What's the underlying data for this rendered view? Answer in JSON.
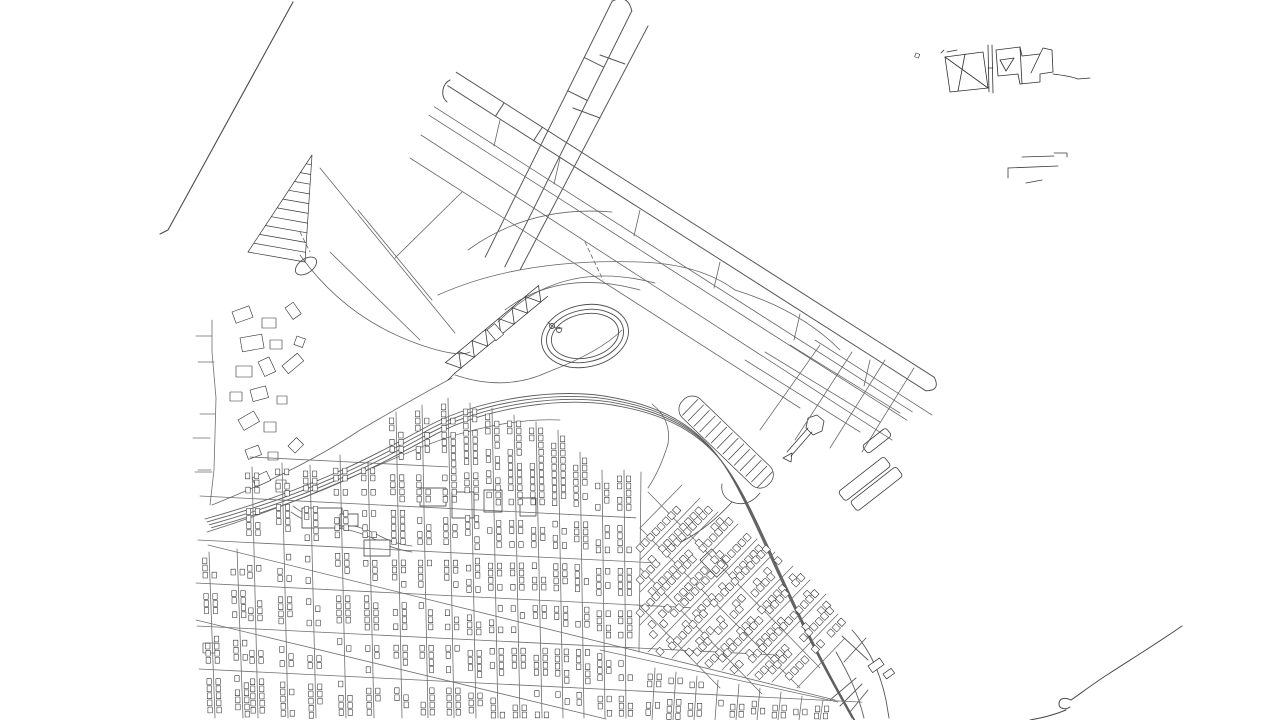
{
  "meta": {
    "kind": "vector-line-map",
    "subject": "airport-and-street-grid-line-drawing",
    "background": "#ffffff",
    "ink_dark": "#2e2e2e",
    "ink_mid": "#555555",
    "ink_street": "#6e6e6e"
  },
  "map": {
    "viewbox": "0 0 1280 720",
    "layers": [
      {
        "name": "nw-boundary-line",
        "stroke": "#4a4a4a",
        "width": 1.1,
        "paths": [
          "M293,2 L168,230 L160,234"
        ]
      },
      {
        "name": "runway-ne-sw",
        "stroke": "#585858",
        "width": 1.0,
        "paths": [
          "M631.8,10.9 L504.8,266.9",
          "M612.2,1.1 L485.2,257.1",
          "M612.2,1.1 Q628,-6.5 631.8,10.9",
          "M603.8,67.2 L584.2,57.4",
          "M587.4,100.5 L567.7,90.7",
          "M648,26 L520,270",
          "M600,55 L625,64",
          "M573,108 L600,118"
        ]
      },
      {
        "name": "runway-nw-se",
        "stroke": "#585858",
        "width": 1.0,
        "paths": [
          "M456.3,72.3 L934.3,377.3",
          "M447.7,85.7 L925.7,390.7",
          "M934.3,377.3 Q941,391 925.7,390.7",
          "M450,80 C442,84 440,96 447,102",
          "M504.1,102.8 L495.5,116.2",
          "M542.3,127.2 L533.7,140.6"
        ]
      },
      {
        "name": "taxiways",
        "stroke": "#666666",
        "width": 0.8,
        "paths": [
          "M434.3,106.8 L912.3,411.8",
          "M428.9,115.2 L906.9,420.2",
          "M421,135 L892,440",
          "M410,158 L800,408",
          "M500,120 L494,146",
          "M560,158 L554,184",
          "M640,210 L634,236",
          "M720,262 L714,288",
          "M800,314 L794,340",
          "M870,360 L864,386",
          "M320,168 L455,333",
          "M395,258 L462,192",
          "M358,210 L432,300",
          "M330,252 L420,340"
        ]
      },
      {
        "name": "infield-curves",
        "stroke": "#666666",
        "width": 0.8,
        "paths": [
          "M468,250 Q530,205 612,212",
          "M438,295 Q520,258 640,262",
          "M640,262 Q700,264 735,290",
          "M735,290 Q800,310 840,350",
          "M505,310 Q560,268 640,290",
          "M498,322 Q560,258 655,283",
          "M300,255 Q345,318 418,344 Q458,358 470,352",
          "M652,404 Q672,420 668,444",
          "M668,444 Q660,470 648,488",
          "M212,505 Q300,470 360,430 Q420,395 452,378",
          "M455,375 Q505,392 548,372 Q600,352 622,330"
        ]
      },
      {
        "name": "infield-dashes",
        "stroke": "#666666",
        "width": 0.8,
        "dash": "4 3",
        "paths": [
          "M585,242 L603,280",
          "M300,232 L310,252"
        ]
      },
      {
        "name": "pier-hatch-structure",
        "stroke": "#3a3a3a",
        "width": 0.7,
        "paths": [
          "M312,155 L248,252 L305,262 Z",
          "M306.2,163.8 L311.4,164.7",
          "M300.4,172.6 L310.7,174.5",
          "M294.5,181.5 L310.1,184.2",
          "M288.7,190.3 L309.5,193.9",
          "M282.9,199.1 L308.8,203.6",
          "M277.1,207.9 L308.2,213.4",
          "M271.3,216.7 L307.5,223.1",
          "M265.5,225.5 L306.9,232.8",
          "M259.6,234.4 L306.3,242.5",
          "M253.8,243.2 L305.6,252.3"
        ]
      },
      {
        "name": "terminal-zigzag",
        "stroke": "#3a3a3a",
        "width": 0.8,
        "paths": [
          "M454.5,373.4 L547.5,296.4",
          "M445.5,362.6 L538.5,285.6",
          "M445.5,362.6 L461.1,368.3 L458.8,351.6 L474.4,357.3 L472.1,340.6 L487.7,346.3 L485.4,329.6 L501,335.3 L498.7,318.6 L514.3,324.3 L512,307.6 L527.6,313.3 L525.3,296.6 L540.9,302.3 L538.5,285.6",
          "M455,373 L448,380"
        ]
      },
      {
        "name": "west-roads",
        "stroke": "#6e6e6e",
        "width": 0.8,
        "paths": [
          "M212,320 L212,352 L216,398 L214,470 L210,505",
          "M196,336 L212,336",
          "M198,362 L214,362",
          "M200,414 L215,414",
          "M198,470 L211,470",
          "M193,438 L210,438",
          "M195,472 L212,472"
        ]
      },
      {
        "name": "creek",
        "stroke": "#6a6a6a",
        "width": 0.8,
        "paths": [
          "M293,506 q18,14 40,16 q26,3 45,13 q16,9 34,11",
          "M291,512 q18,13 40,15 q26,3 45,13 q16,9 36,12"
        ]
      },
      {
        "name": "service-road",
        "stroke": "#6a6a6a",
        "width": 0.8,
        "paths": [
          "M207,532 C300,503 360,472 424,446 C470,428 520,418 560,420"
        ]
      },
      {
        "name": "parking-hook",
        "stroke": "#4a4a4a",
        "width": 0.8,
        "paths": [
          "M760,493 Q748,508 732,502 Q720,496 722,484",
          "M732,502 C712,524 692,538 668,548"
        ]
      },
      {
        "name": "tower-building",
        "stroke": "#3a3a3a",
        "width": 0.8,
        "paths": [
          "M787,452 L808,428",
          "M791,456 L812,432",
          "M806,428 L808,418 L817,415 L824,421 L822,431 L813,435 Z",
          "M783,458 l9,-5 l-1,9 z"
        ]
      },
      {
        "name": "basin-roads",
        "stroke": "#6a6a6a",
        "width": 0.8,
        "paths": [
          "M745,360 L860,432",
          "M765,352 L880,422",
          "M790,345 L900,413",
          "M815,340 L932,415",
          "M760,430 L820,345",
          "M795,440 L852,352",
          "M830,448 L885,360",
          "M862,452 L914,368"
        ]
      },
      {
        "name": "interchange",
        "stroke": "#5a5a5a",
        "width": 0.9,
        "paths": [
          "M842,636 L868,660",
          "M866,638 L844,662",
          "M852,630 C870,650 880,672 886,700 L889,718",
          "M836,652 C850,676 858,694 864,718",
          "M856,678 L830,700",
          "M862,684 L840,706",
          "M868,690 L850,712"
        ]
      },
      {
        "name": "shoreline-se",
        "stroke": "#4a4a4a",
        "width": 1.0,
        "paths": [
          "M1182,626 C1156,644 1130,660 1110,673 C1094,683 1080,694 1071,700 C1065,697 1059,698 1059,704 C1059,709 1066,710 1070,707",
          "M1066,710 C1054,715 1042,718 1030,720"
        ]
      },
      {
        "name": "ne-building-cluster",
        "stroke": "#2f2f2f",
        "width": 0.8,
        "paths": [
          "M945,57 L983,52 L988,88 L950,92 Z",
          "M945,57 L988,88",
          "M965,54 L958,91",
          "M947,52 L957,50",
          "M988,45 L989,92",
          "M992,45 L993,93",
          "M988,68 L993,68",
          "M996,50 L1020,47 L1022,56 L1040,54 L1043,48 L1052,50 L1053,72 L1040,74 L1040,82 L1020,84 L1018,74 L998,76 Z",
          "M1020,47 L1022,84",
          "M1040,54 L1031,73",
          "M1000,60 L1014,58 L1006,71 Z",
          "M1053,74 Q1070,76 1078,79 L1090,78",
          "M941,53 l3,-3"
        ]
      },
      {
        "name": "ne-docks",
        "stroke": "#3a3a3a",
        "width": 0.8,
        "paths": [
          "M1022,157 L1054,156",
          "M1054,153 L1067,153 L1067,157",
          "M1008,168 L1008,178",
          "M1008,168 L1058,166",
          "M1026,183 L1042,180"
        ]
      }
    ],
    "ellipses": {
      "name": "oval-loop",
      "stroke": "#4f4f4f",
      "width": 0.9,
      "cx": 585,
      "cy": 336,
      "rot": -12,
      "rings": [
        [
          44,
          31
        ],
        [
          39,
          26
        ],
        [
          34,
          22
        ]
      ],
      "inner_circles": [
        [
          552,
          326,
          2.5
        ],
        [
          559,
          330,
          2.5
        ]
      ],
      "inner_path": "M548,322 q6,8 14,6",
      "small_loop": {
        "cx": 306,
        "cy": 266,
        "rx": 12,
        "ry": 7,
        "rot": -35
      }
    },
    "highway": {
      "name": "highway",
      "stroke": "#5f5f5f",
      "width": 0.9,
      "start": [
        205,
        519
      ],
      "curves": [
        [
          320,
          487,
          380,
          452,
          430,
          425
        ],
        [
          480,
          399,
          560,
          386,
          615,
          398
        ],
        [
          668,
          408,
          700,
          430,
          722,
          462
        ],
        [
          745,
          495,
          770,
          560,
          800,
          620
        ],
        [
          815,
          652,
          835,
          688,
          852,
          718
        ]
      ],
      "lanes": 4,
      "lane_offset": [
        2.2,
        2.9
      ]
    },
    "parking": {
      "name": "parking-hairpin",
      "stroke": "#3a3a3a",
      "width": 0.7,
      "x": 692,
      "y": 391,
      "len": 120,
      "depth": 26,
      "radius": 12,
      "rot": 44,
      "stripe_from": 10,
      "stripe_step": 8
    },
    "rect_layers": [
      {
        "name": "west-buildings",
        "stroke": "#2e2e2e",
        "width": 0.6,
        "fill": "#ffffff",
        "rects": [
          [
            232,
            312,
            18,
            12,
            -20
          ],
          [
            262,
            318,
            14,
            10,
            0
          ],
          [
            285,
            308,
            10,
            14,
            -35
          ],
          [
            240,
            338,
            22,
            14,
            -10
          ],
          [
            270,
            340,
            12,
            9,
            0
          ],
          [
            297,
            336,
            9,
            9,
            20
          ],
          [
            236,
            366,
            16,
            11,
            0
          ],
          [
            258,
            362,
            12,
            16,
            -25
          ],
          [
            282,
            366,
            20,
            10,
            -40
          ],
          [
            230,
            392,
            12,
            9,
            0
          ],
          [
            250,
            390,
            16,
            12,
            -15
          ],
          [
            277,
            396,
            10,
            8,
            0
          ],
          [
            238,
            420,
            18,
            12,
            -30
          ],
          [
            264,
            422,
            12,
            10,
            0
          ],
          [
            245,
            450,
            14,
            10,
            -20
          ],
          [
            268,
            452,
            10,
            8,
            0
          ],
          [
            288,
            446,
            12,
            10,
            -45
          ],
          [
            252,
            478,
            16,
            10,
            -25
          ],
          [
            276,
            480,
            10,
            12,
            0
          ],
          [
            203,
            643,
            12,
            10,
            0
          ],
          [
            487,
            330,
            10,
            14,
            -40
          ],
          [
            916,
            53,
            4,
            4,
            20
          ]
        ]
      },
      {
        "name": "piers",
        "stroke": "#3a3a3a",
        "width": 0.8,
        "fill": "none",
        "rx": 3,
        "rects": [
          [
            838,
            492,
            58,
            12,
            -38
          ],
          [
            850,
            502,
            58,
            12,
            -38
          ],
          [
            862,
            446,
            30,
            10,
            -38
          ]
        ]
      },
      {
        "name": "big-blocks",
        "stroke": "#2e2e2e",
        "width": 0.7,
        "fill": "#ffffff",
        "rects": [
          [
            420,
            488,
            26,
            18,
            0
          ],
          [
            452,
            492,
            22,
            26,
            0
          ],
          [
            484,
            490,
            18,
            22,
            0
          ],
          [
            302,
            508,
            40,
            20,
            0
          ],
          [
            340,
            514,
            18,
            12,
            0
          ],
          [
            364,
            540,
            26,
            16,
            0
          ],
          [
            520,
            498,
            16,
            18,
            0
          ],
          [
            700,
            560,
            16,
            24,
            -44
          ],
          [
            868,
            666,
            14,
            8,
            -35
          ],
          [
            883,
            674,
            10,
            6,
            -35
          ]
        ]
      }
    ],
    "grid": {
      "name": "street-grid",
      "stroke": "#6e6e6e",
      "width": 0.8,
      "vertical_streets": [
        [
          209,
          552,
          215,
          718,
          1
        ],
        [
          237,
          549,
          243,
          718,
          1
        ],
        [
          252,
          467,
          258,
          718,
          1
        ],
        [
          282,
          463,
          288,
          718,
          1
        ],
        [
          310,
          465,
          316,
          718,
          1
        ],
        [
          340,
          455,
          346,
          718,
          1
        ],
        [
          368,
          462,
          374,
          718,
          1
        ],
        [
          396,
          412,
          402,
          718,
          1
        ],
        [
          422,
          405,
          428,
          718,
          1
        ],
        [
          448,
          398,
          454,
          718,
          1
        ],
        [
          470,
          403,
          476,
          718,
          1
        ],
        [
          492,
          408,
          498,
          718,
          1
        ],
        [
          514,
          415,
          520,
          718,
          1
        ],
        [
          536,
          422,
          542,
          718,
          1
        ],
        [
          558,
          430,
          563,
          718,
          1
        ],
        [
          580,
          452,
          584,
          718,
          1
        ],
        [
          602,
          470,
          605,
          718,
          1
        ],
        [
          624,
          470,
          626,
          718,
          1
        ],
        [
          641,
          472,
          639,
          652,
          0
        ],
        [
          655,
          668,
          652,
          720,
          1
        ],
        [
          676,
          672,
          673,
          720,
          1
        ],
        [
          697,
          676,
          694,
          720,
          1
        ],
        [
          718,
          680,
          715,
          720,
          1
        ],
        [
          739,
          684,
          736,
          720,
          1
        ],
        [
          760,
          688,
          757,
          720,
          1
        ],
        [
          781,
          692,
          778,
          720,
          1
        ],
        [
          802,
          696,
          799,
          720,
          1
        ],
        [
          823,
          700,
          820,
          720,
          1
        ]
      ],
      "horizontal_streets": [
        [
          250,
          457,
          448
        ],
        [
          200,
          496,
          636
        ],
        [
          198,
          540,
          660
        ],
        [
          196,
          583,
          690
        ],
        [
          197,
          626,
          782
        ],
        [
          199,
          669,
          862
        ]
      ],
      "h_slope": 0.05,
      "diagonals": [
        [
          208,
          545,
          835,
          700
        ],
        [
          196,
          620,
          606,
          719
        ],
        [
          600,
          650,
          838,
          702
        ]
      ]
    },
    "rotated_grid": {
      "name": "rotated-street-grid",
      "stroke": "#6e6e6e",
      "width": 0.8,
      "streets_a": [
        [
          640,
          560,
          700,
          498,
          1
        ],
        [
          640,
          592,
          718,
          512,
          1
        ],
        [
          640,
          625,
          738,
          524,
          1
        ],
        [
          648,
          652,
          757,
          539,
          1
        ],
        [
          672,
          658,
          775,
          552,
          1
        ],
        [
          697,
          664,
          793,
          566,
          1
        ],
        [
          722,
          670,
          810,
          580,
          1
        ],
        [
          747,
          676,
          826,
          594,
          1
        ],
        [
          772,
          682,
          838,
          614,
          1
        ],
        [
          797,
          688,
          845,
          638,
          0
        ],
        [
          640,
          528,
          682,
          485,
          0
        ]
      ],
      "streets_b": [
        [
          648,
          492,
          820,
          668
        ],
        [
          640,
          528,
          800,
          688
        ],
        [
          640,
          568,
          762,
          694
        ],
        [
          640,
          606,
          720,
          688
        ]
      ]
    },
    "buildings": {
      "name": "building-rows",
      "stroke": "#2e2e2e",
      "width": 0.55,
      "fill": "#ffffff",
      "seed": 11,
      "offset": 4.5,
      "cell_w": 4.4,
      "cell_h": 5.8,
      "step": 7.1,
      "skip_prob": 0.18,
      "gap_half": 7,
      "stop_y": 714,
      "rot": {
        "offset": 5,
        "cell_len": 5.5,
        "depth": 6.5,
        "step": 7.5,
        "skip_prob": 0.22
      }
    }
  }
}
